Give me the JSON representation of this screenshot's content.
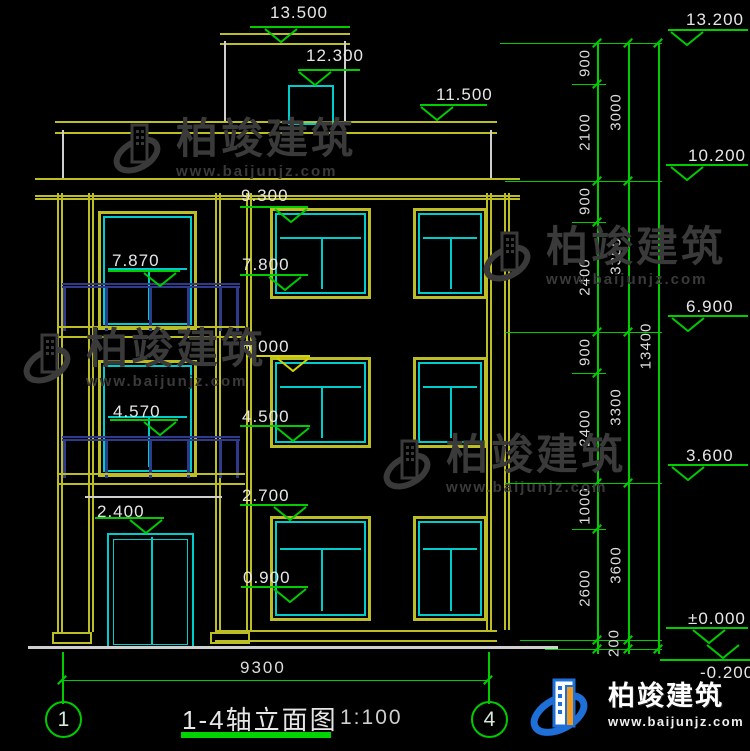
{
  "drawing": {
    "title": "1-4轴立面图",
    "scale": "1:100",
    "axis_labels": [
      "1",
      "4"
    ],
    "overall_width_dim": "9300",
    "left_levels": [
      "13.500",
      "12.300",
      "11.500",
      "9.300",
      "7.870",
      "7.800",
      "6.000",
      "4.570",
      "4.500",
      "2.700",
      "2.400",
      "0.900"
    ],
    "right_levels": [
      "13.200",
      "10.200",
      "6.900",
      "3.600",
      "±0.000",
      "-0.200"
    ],
    "dim_col1": [
      "900",
      "2100",
      "900",
      "2400",
      "900",
      "2400",
      "1000",
      "2600",
      "200"
    ],
    "dim_col2": [
      "3000",
      "3300",
      "3300",
      "3600"
    ],
    "dim_total": "13400"
  },
  "watermark": {
    "brand": "柏竣建筑",
    "url": "www.baijunjz.com"
  },
  "logo": {
    "brand": "柏竣建筑",
    "url": "www.baijunjz.com"
  },
  "colors": {
    "background": "#000000",
    "dim_green": "#00cc00",
    "frame_yellow": "#bdbd24",
    "marker_yellow": "#d4d400",
    "window_cyan": "#00cccc",
    "railing_navy": "#2e3a8c",
    "wall_white": "#cfcfcf",
    "text_white": "#e6e6e6",
    "watermark_gray": "#3a3a3a",
    "logo_blue": "#1e6fd8",
    "logo_orange": "#f29c1f"
  }
}
